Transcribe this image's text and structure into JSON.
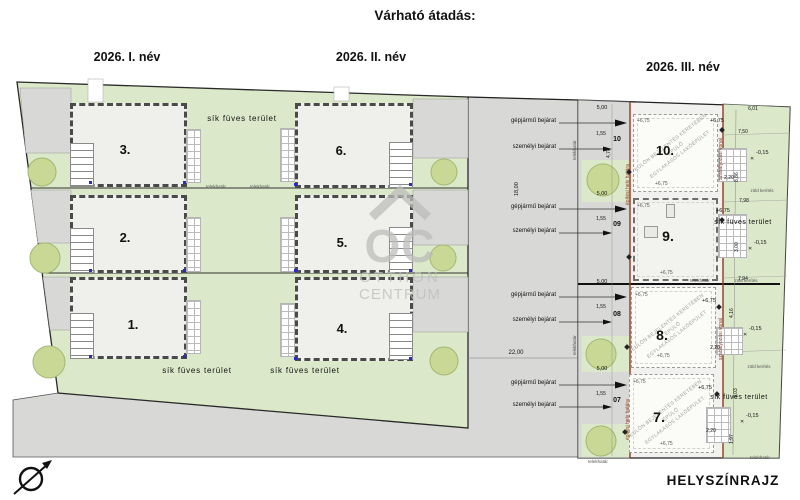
{
  "title": "Várható átadás:",
  "phases": [
    {
      "label": "2026. I. név"
    },
    {
      "label": "2026. II. név"
    },
    {
      "label": "2026. III. név"
    }
  ],
  "watermark": {
    "monogram": "OC",
    "line1": "OTTHON",
    "line2": "CENTRUM"
  },
  "labels": {
    "grass": "sík füves terület",
    "plot_boundary": "telekhatár",
    "green_fence": "zöld kerítés",
    "vehicle_entrance": "gépjármű bejárat",
    "person_entrance": "személyi bejárat",
    "building_envelope": "építési hely határa",
    "regulation_line": "szabályozási vonal",
    "note_line1": "KÜLÖN BEJELENTÉS KERETÉBEN ÉPÜLŐ",
    "note_line2": "EGYLAKÁSOS LAKÓÉPÜLET",
    "drawing_type": "HELYSZÍNRAJZ"
  },
  "left_site": {
    "units": [
      {
        "number": "1."
      },
      {
        "number": "2."
      },
      {
        "number": "3."
      },
      {
        "number": "4."
      },
      {
        "number": "5."
      },
      {
        "number": "6."
      }
    ]
  },
  "right_site": {
    "units": [
      {
        "number": "7.",
        "code": "07"
      },
      {
        "number": "8.",
        "code": "08"
      },
      {
        "number": "9.",
        "code": "09"
      },
      {
        "number": "10.",
        "code": "10"
      }
    ]
  },
  "levels": {
    "upper": "+6,75",
    "ground": "-0,15"
  },
  "dims": {
    "road_width": "22,00",
    "road_length": "18,00",
    "drive_width": "5,00",
    "gate_width": "1,55",
    "drive_depth": "4,78",
    "g1": "6,01",
    "g2": "7,50",
    "g3": "8,86",
    "g4": "2,20",
    "g5": "7,98",
    "g6": "3,00",
    "g7": "7,94",
    "g8": "4,16",
    "g9": "9,03",
    "g10": "1,97",
    "g11": "2,20",
    "g12": "2,20"
  },
  "colors": {
    "grass": "#dbe8c9",
    "tree": "#cad896",
    "road": "#d8d8d6",
    "red_line": "#8e3a1e",
    "marker_blue": "#2a2ac4"
  }
}
